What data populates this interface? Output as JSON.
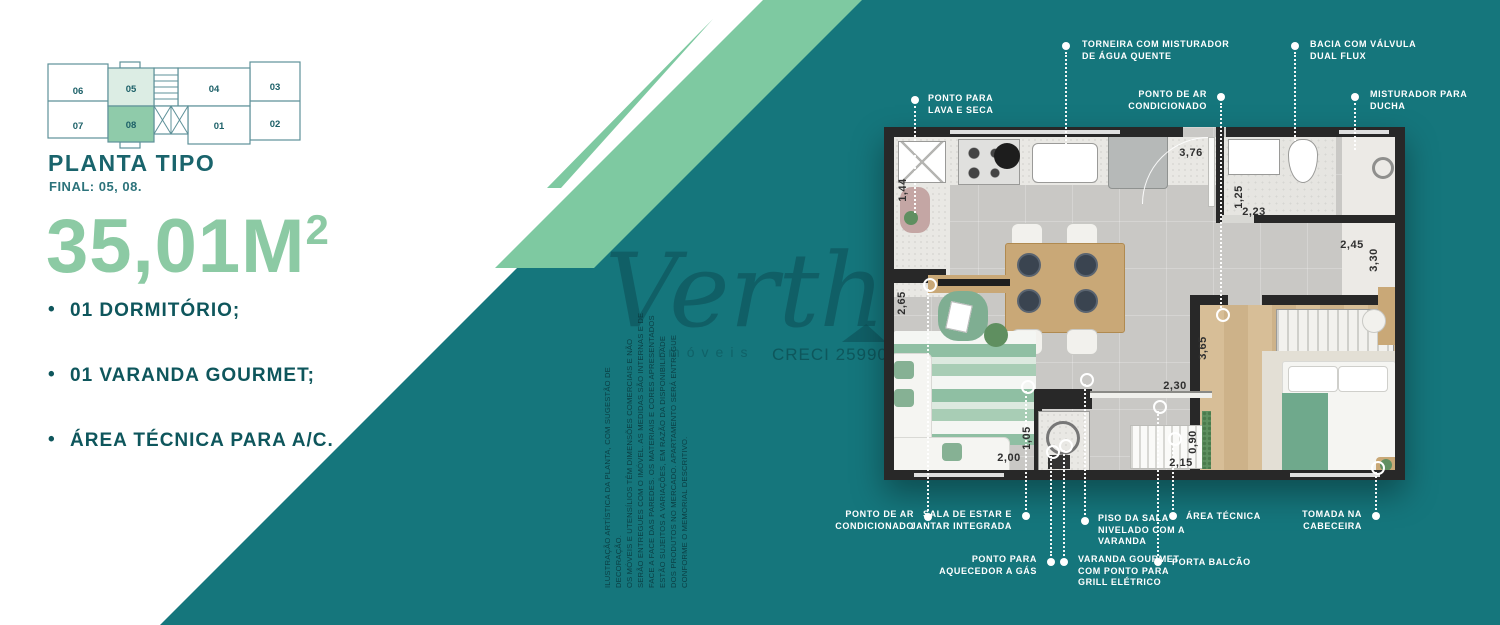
{
  "colors": {
    "teal": "#15767C",
    "mint": "#7EC9A1",
    "mint_light": "#DCEDE4",
    "unit_highlight": "#8FCBAA",
    "heading": "#1A646C",
    "feature_text": "#0E565C",
    "area_text": "#8CCAA4",
    "wall": "#282828"
  },
  "keyplan": {
    "title": "PLANTA TIPO",
    "subtitle": "FINAL: 05, 08.",
    "units": [
      "06",
      "05",
      "04",
      "03",
      "07",
      "08",
      "01",
      "02"
    ],
    "highlighted_units": [
      "05",
      "08"
    ]
  },
  "area": {
    "value": "35,01M",
    "sup": "2"
  },
  "features": [
    "01 DORMITÓRIO;",
    "01 VARANDA GOURMET;",
    "ÁREA TÉCNICA PARA A/C."
  ],
  "watermark": {
    "brand": "Verth",
    "sub": "imóveis",
    "creci": "CRECI 25990"
  },
  "disclaimer": [
    "ILUSTRAÇÃO ARTÍSTICA DA PLANTA, COM SUGESTÃO DE DECORAÇÃO.",
    "OS MÓVEIS E UTENSÍLIOS TÊM DIMENSÕES COMERCIAIS E NÃO",
    "SERÃO ENTREGUES COM O IMÓVEL. AS MEDIDAS SÃO INTERNAS E DE",
    "FACE A FACE DAS PAREDES. OS MATERIAIS E CORES APRESENTADOS",
    "ESTÃO SUJEITOS A VARIAÇÕES, EM RAZÃO DA DISPONIBILIDADE",
    "DOS PRODUTOS NO MERCADO. APARTAMENTO SERÁ ENTREGUE",
    "CONFORME O MEMORIAL DESCRITIVO."
  ],
  "floorplan": {
    "dimensions": [
      {
        "text": "1,44",
        "x": 903,
        "y": 190,
        "v": true
      },
      {
        "text": "3,76",
        "x": 1191,
        "y": 153,
        "v": false
      },
      {
        "text": "1,25",
        "x": 1239,
        "y": 197,
        "v": true
      },
      {
        "text": "2,23",
        "x": 1254,
        "y": 212,
        "v": false
      },
      {
        "text": "2,45",
        "x": 1352,
        "y": 245,
        "v": false
      },
      {
        "text": "3,30",
        "x": 1374,
        "y": 260,
        "v": true
      },
      {
        "text": "2,65",
        "x": 902,
        "y": 303,
        "v": true
      },
      {
        "text": "1,05",
        "x": 1027,
        "y": 438,
        "v": true
      },
      {
        "text": "2,00",
        "x": 1009,
        "y": 458,
        "v": false
      },
      {
        "text": "2,30",
        "x": 1175,
        "y": 386,
        "v": false
      },
      {
        "text": "3,65",
        "x": 1203,
        "y": 348,
        "v": true
      },
      {
        "text": "0,90",
        "x": 1193,
        "y": 442,
        "v": true
      },
      {
        "text": "2,15",
        "x": 1181,
        "y": 463,
        "v": false
      }
    ],
    "callouts": [
      {
        "id": "torneira-misturador",
        "lines": [
          "TORNEIRA COM MISTURADOR",
          "DE ÁGUA QUENTE"
        ],
        "align": "left",
        "label": [
          1082,
          39
        ],
        "dot": [
          1066,
          46
        ],
        "line": [
          1066,
          52,
          160
        ],
        "ring": null
      },
      {
        "id": "bacia-dual-flux",
        "lines": [
          "BACIA COM VÁLVULA",
          "DUAL FLUX"
        ],
        "align": "left",
        "label": [
          1310,
          39
        ],
        "dot": [
          1295,
          46
        ],
        "line": [
          1295,
          52,
          148
        ],
        "ring": null
      },
      {
        "id": "ponto-ar-condicionado-topo",
        "lines": [
          "PONTO DE AR",
          "CONDICIONADO"
        ],
        "align": "right",
        "label": [
          1207,
          89
        ],
        "dot": [
          1221,
          97
        ],
        "line": [
          1221,
          103,
          308
        ],
        "ring": [
          1221,
          313
        ]
      },
      {
        "id": "misturador-ducha",
        "lines": [
          "MISTURADOR PARA",
          "DUCHA"
        ],
        "align": "left",
        "label": [
          1370,
          89
        ],
        "dot": [
          1355,
          97
        ],
        "line": [
          1355,
          103,
          150
        ],
        "ring": null
      },
      {
        "id": "ponto-lava-seca",
        "lines": [
          "PONTO PARA",
          "LAVA E SECA"
        ],
        "align": "left",
        "label": [
          928,
          93
        ],
        "dot": [
          915,
          100
        ],
        "line": [
          915,
          106,
          213
        ],
        "ring": null
      },
      {
        "id": "ponto-ar-condicionado-baixo",
        "lines": [
          "PONTO DE AR",
          "CONDICIONADO"
        ],
        "align": "right",
        "label": [
          914,
          509
        ],
        "dot": [
          928,
          517
        ],
        "line": [
          928,
          289,
          511
        ],
        "ring": [
          928,
          283
        ]
      },
      {
        "id": "sala-estar-jantar",
        "lines": [
          "SALA DE ESTAR E",
          "JANTAR INTEGRADA"
        ],
        "align": "right",
        "label": [
          1012,
          509
        ],
        "dot": [
          1026,
          516
        ],
        "line": [
          1026,
          391,
          510
        ],
        "ring": [
          1026,
          385
        ]
      },
      {
        "id": "piso-sala-nivelado",
        "lines": [
          "PISO DA SALA",
          "NIVELADO COM A",
          "VARANDA"
        ],
        "align": "left",
        "label": [
          1098,
          513
        ],
        "dot": [
          1085,
          521
        ],
        "line": [
          1085,
          384,
          515
        ],
        "ring": [
          1085,
          378
        ]
      },
      {
        "id": "aquecedor-gas",
        "lines": [
          "PONTO PARA",
          "AQUECEDOR A GÁS"
        ],
        "align": "right",
        "label": [
          1037,
          554
        ],
        "dot": [
          1051,
          562
        ],
        "line": [
          1051,
          456,
          556
        ],
        "ring": [
          1051,
          450
        ]
      },
      {
        "id": "varanda-gourmet",
        "lines": [
          "VARANDA GOURMET",
          "COM PONTO PARA",
          "GRILL ELÉTRICO"
        ],
        "align": "left",
        "label": [
          1078,
          554
        ],
        "dot": [
          1064,
          562
        ],
        "line": [
          1064,
          450,
          556
        ],
        "ring": [
          1064,
          444
        ]
      },
      {
        "id": "area-tecnica",
        "lines": [
          "ÁREA TÉCNICA"
        ],
        "align": "left",
        "label": [
          1186,
          511
        ],
        "dot": [
          1173,
          516
        ],
        "line": [
          1173,
          443,
          510
        ],
        "ring": [
          1173,
          437
        ]
      },
      {
        "id": "porta-balcao",
        "lines": [
          "PORTA BALCÃO"
        ],
        "align": "left",
        "label": [
          1172,
          557
        ],
        "dot": [
          1158,
          562
        ],
        "line": [
          1158,
          411,
          556
        ],
        "ring": [
          1158,
          405
        ]
      },
      {
        "id": "tomada-cabeceira",
        "lines": [
          "TOMADA NA",
          "CABECEIRA"
        ],
        "align": "right",
        "label": [
          1362,
          509
        ],
        "dot": [
          1376,
          516
        ],
        "line": [
          1376,
          472,
          510
        ],
        "ring": [
          1376,
          466
        ]
      }
    ]
  }
}
